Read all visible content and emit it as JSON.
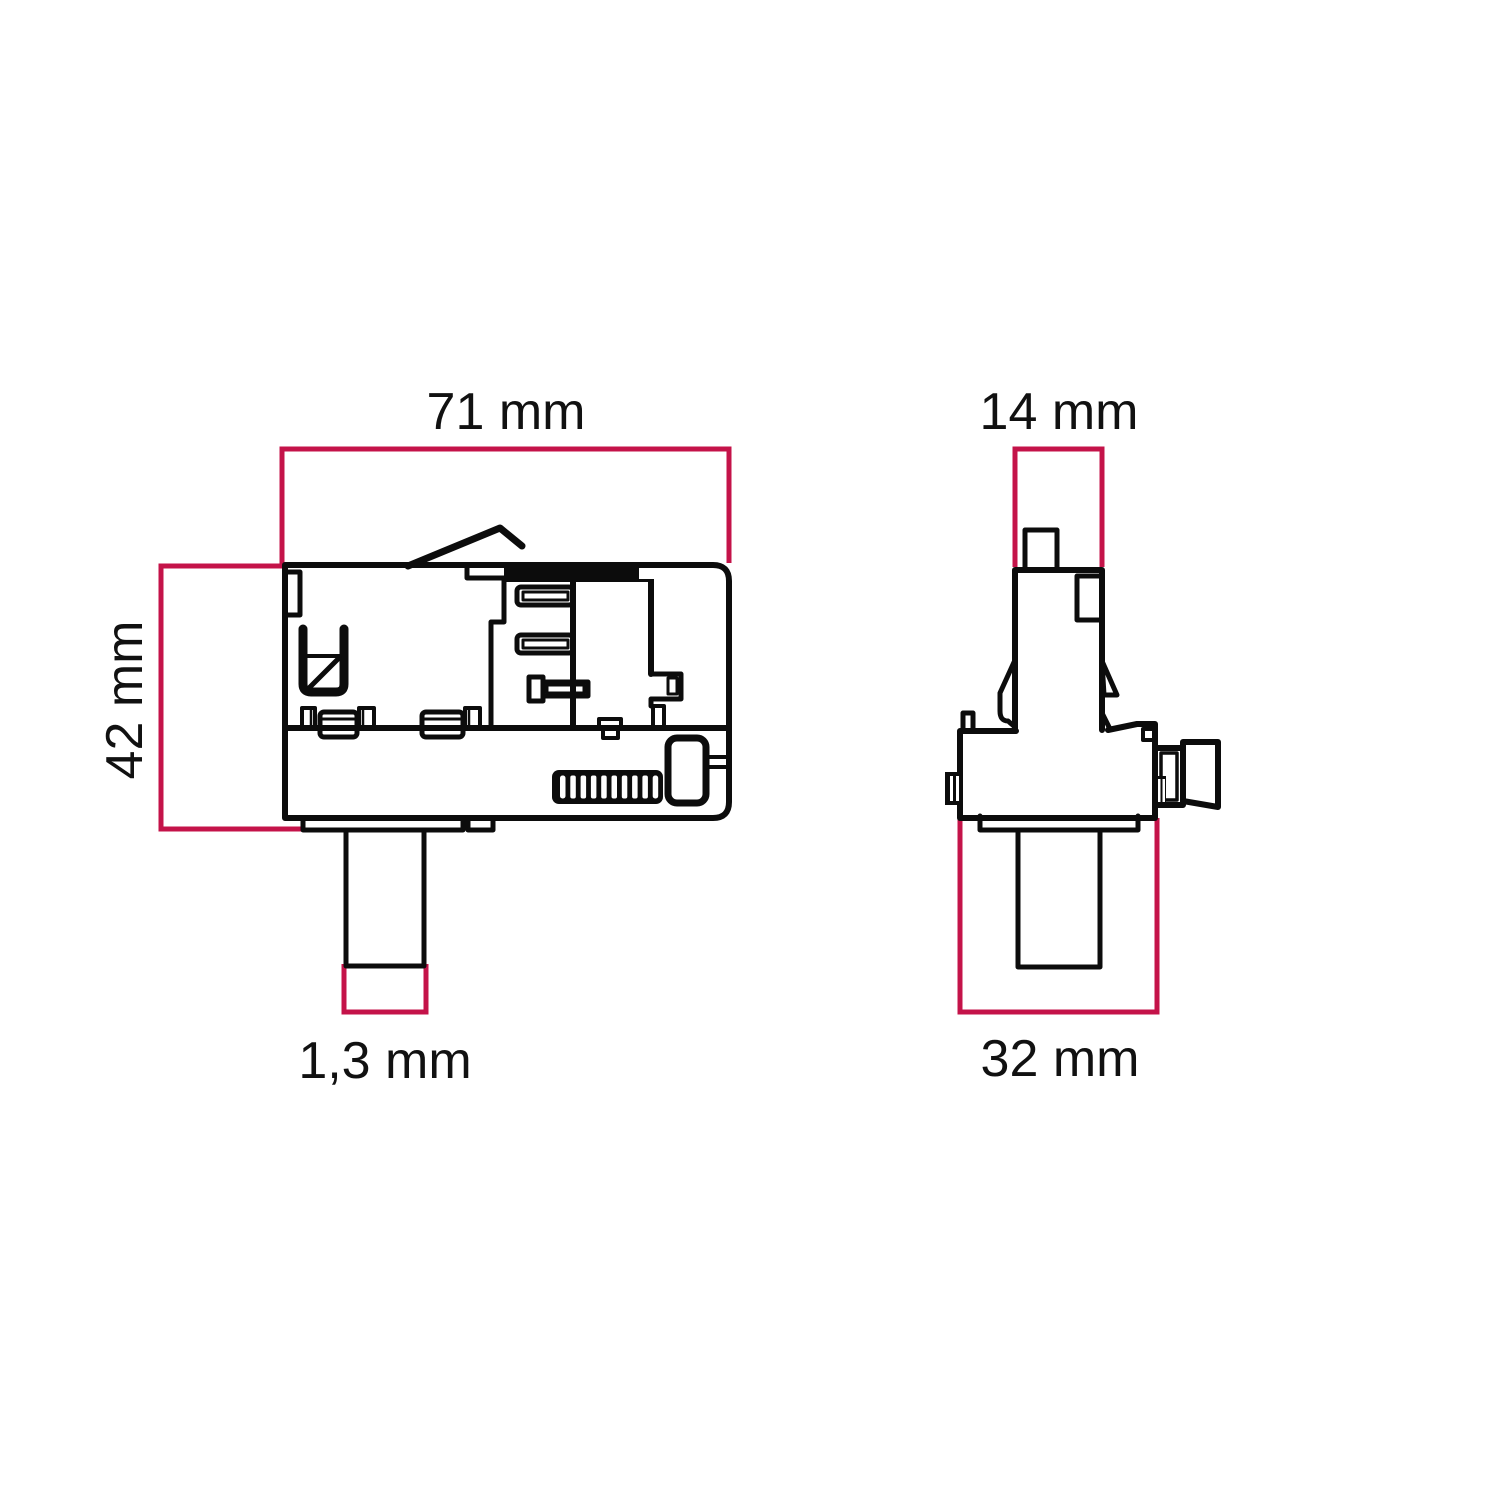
{
  "diagram": {
    "views": {
      "side_view": {
        "name": "side-view",
        "width_label": "71 mm",
        "height_label": "42 mm",
        "pin_label": "1,3 mm"
      },
      "front_view": {
        "name": "front-view",
        "width_label": "14 mm",
        "base_label": "32 mm"
      }
    },
    "colors": {
      "line": "#0c0c0c",
      "dimension": "#c41349",
      "background": "#ffffff"
    }
  }
}
